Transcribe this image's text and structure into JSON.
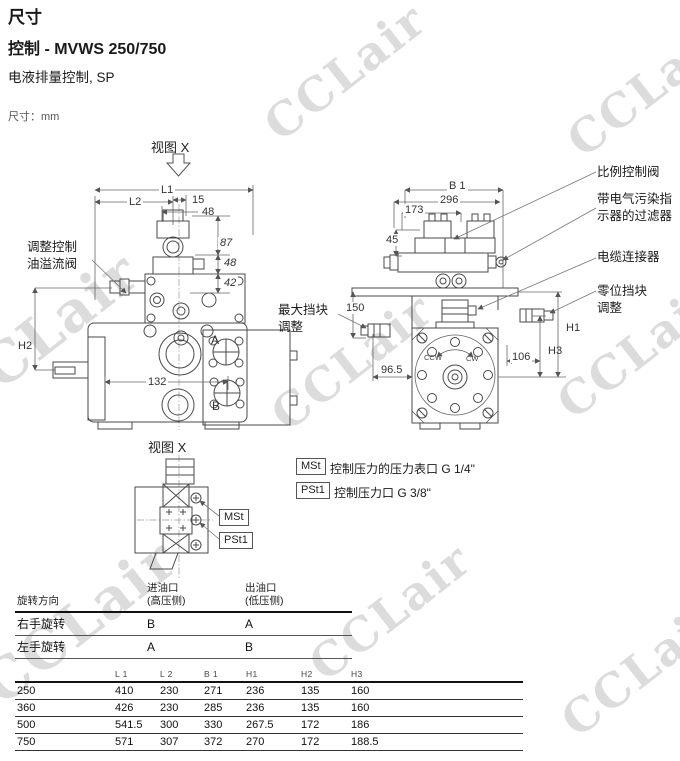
{
  "page": {
    "title": "尺寸",
    "subtitle": "控制 - MVWS 250/750",
    "description": "电液排量控制, SP",
    "units_note": "尺寸：mm"
  },
  "watermark": {
    "text": "CCLair",
    "color": "#dcdcdc"
  },
  "front_view": {
    "view_label": "视图 X",
    "callout_relief_valve": "调整控制油溢流阀",
    "dim_l1": "L1",
    "dim_l2": "L2",
    "dim_15": "15",
    "dim_48_top": "48",
    "dim_87": "87",
    "dim_48_side": "48",
    "dim_42": "42",
    "dim_h2": "H2",
    "dim_132": "132",
    "port_a": "A",
    "port_b": "B"
  },
  "side_view": {
    "dim_b1": "B 1",
    "dim_296": "296",
    "dim_173": "173",
    "dim_45": "45",
    "dim_150": "150",
    "dim_96_5": "96.5",
    "dim_106": "106",
    "dim_h1": "H1",
    "dim_h3": "H3",
    "label_ccw": "CCW",
    "label_cw": "CW",
    "callout_proportional_valve": "比例控制阀",
    "callout_filter": "带电气污染指示器的过滤器",
    "callout_cable_connector": "电缆连接器",
    "callout_zero_stop": "零位挡块调整",
    "callout_max_stop": "最大挡块调整"
  },
  "detail_view": {
    "view_label": "视图 X",
    "tag_mst": "MSt",
    "tag_pst1": "PSt1"
  },
  "port_legend": {
    "items": [
      {
        "tag": "MSt",
        "text": "控制压力的压力表口 G 1/4\""
      },
      {
        "tag": "PSt1",
        "text": "控制压力口 G 3/8\""
      }
    ]
  },
  "rotation_table": {
    "col_direction": "旋转方向",
    "col_inlet": "进油口\n(高压侧)",
    "col_outlet": "出油口\n(低压侧)",
    "rows": [
      {
        "direction": "右手旋转",
        "inlet": "B",
        "outlet": "A"
      },
      {
        "direction": "左手旋转",
        "inlet": "A",
        "outlet": "B"
      }
    ]
  },
  "dimension_table": {
    "headers": [
      "",
      "L 1",
      "L 2",
      "B 1",
      "H1",
      "H2",
      "H3"
    ],
    "rows": [
      {
        "size": "250",
        "l1": "410",
        "l2": "230",
        "b1": "271",
        "h1": "236",
        "h2": "135",
        "h3": "160"
      },
      {
        "size": "360",
        "l1": "426",
        "l2": "230",
        "b1": "285",
        "h1": "236",
        "h2": "135",
        "h3": "160"
      },
      {
        "size": "500",
        "l1": "541.5",
        "l2": "300",
        "b1": "330",
        "h1": "267.5",
        "h2": "172",
        "h3": "186"
      },
      {
        "size": "750",
        "l1": "571",
        "l2": "307",
        "b1": "372",
        "h1": "270",
        "h2": "172",
        "h3": "188.5"
      }
    ]
  }
}
